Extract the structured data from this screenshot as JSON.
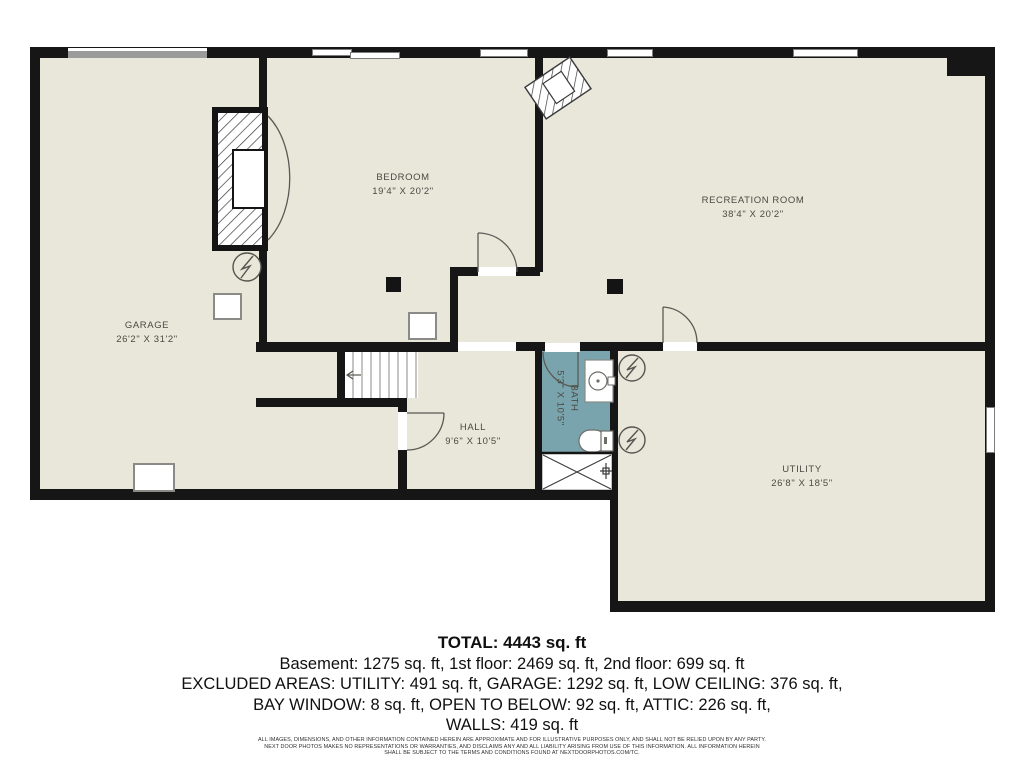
{
  "rooms": {
    "garage": {
      "name": "GARAGE",
      "dims": "26'2\" X 31'2\""
    },
    "bedroom": {
      "name": "BEDROOM",
      "dims": "19'4\" X 20'2\""
    },
    "recreation": {
      "name": "RECREATION ROOM",
      "dims": "38'4\" X 20'2\""
    },
    "hall": {
      "name": "HALL",
      "dims": "9'6\" X 10'5\""
    },
    "bath": {
      "name": "BATH",
      "dims": "5'3\" X 10'5\""
    },
    "utility": {
      "name": "UTILITY",
      "dims": "26'8\" X 18'5\""
    }
  },
  "summary": {
    "total": "TOTAL: 4443 sq. ft",
    "floors": "Basement: 1275 sq. ft, 1st floor: 2469 sq. ft, 2nd floor: 699 sq. ft",
    "excluded_line1": "EXCLUDED AREAS: UTILITY: 491 sq. ft, GARAGE: 1292 sq. ft, LOW CEILING: 376 sq. ft,",
    "excluded_line2": "BAY WINDOW: 8 sq. ft, OPEN TO BELOW: 92 sq. ft, ATTIC: 226 sq. ft,",
    "walls": "WALLS: 419 sq. ft"
  },
  "disclaimer": {
    "line1": "ALL IMAGES, DIMENSIONS, AND OTHER INFORMATION CONTAINED HEREIN ARE APPROXIMATE AND FOR ILLUSTRATIVE PURPOSES ONLY, AND SHALL NOT BE RELIED UPON BY ANY PARTY.",
    "line2": "NEXT DOOR PHOTOS MAKES NO REPRESENTATIONS OR WARRANTIES, AND DISCLAIMS ANY AND ALL LIABILITY ARISING FROM USE OF THIS INFORMATION. ALL INFORMATION HEREIN",
    "line3": "SHALL BE SUBJECT TO THE TERMS AND CONDITIONS FOUND AT NEXTDOORPHOTOS.COM/TC."
  },
  "colors": {
    "floor": "#e9e6da",
    "wall": "#161616",
    "bath_tile": "#7aa4ad",
    "garage_door": "#9b9b9b"
  }
}
